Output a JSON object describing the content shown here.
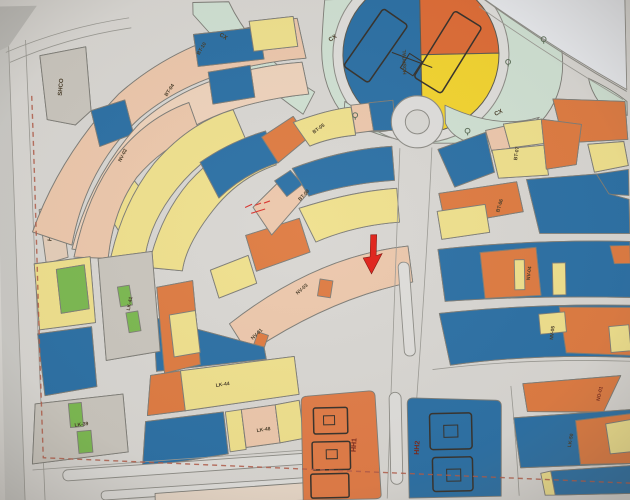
{
  "map": {
    "region_labels": {
      "shco": "SHCO",
      "htkt": "HTKT",
      "cx_top": "CX",
      "cx_left": "CX",
      "cx_bottom": "CX",
      "hospital": "HOSPITAL",
      "bt10": "BT-10",
      "bt04": "BT-04",
      "bt05": "BT-05",
      "bt08": "BT-08",
      "bt07": "BT-07",
      "bt06": "BT-06",
      "nv01": "NV-01",
      "nv02": "NV-02",
      "nv03": "NV-03",
      "nv04": "NV-04",
      "nv05": "NV-05",
      "lk39": "LK-39",
      "lk41": "LK-41",
      "lk44": "LK-44",
      "lk48": "LK-48",
      "lk50": "LK-50",
      "hh1": "HH1",
      "hh2": "HH2",
      "no01": "NO-01"
    },
    "palette": {
      "villa_blue": "#2a6fa4",
      "lot_yellow": "#efe08c",
      "lot_pink": "#ecc7ab",
      "lot_orange": "#de7a40",
      "lot_green": "#7ab84f",
      "lot_gray": "#c9c5bd",
      "greenspace": "#cfe0d2",
      "road_paper": "#d8d6d2",
      "annotation_red": "#e01f16",
      "boundary_dash": "#b05a48"
    }
  }
}
